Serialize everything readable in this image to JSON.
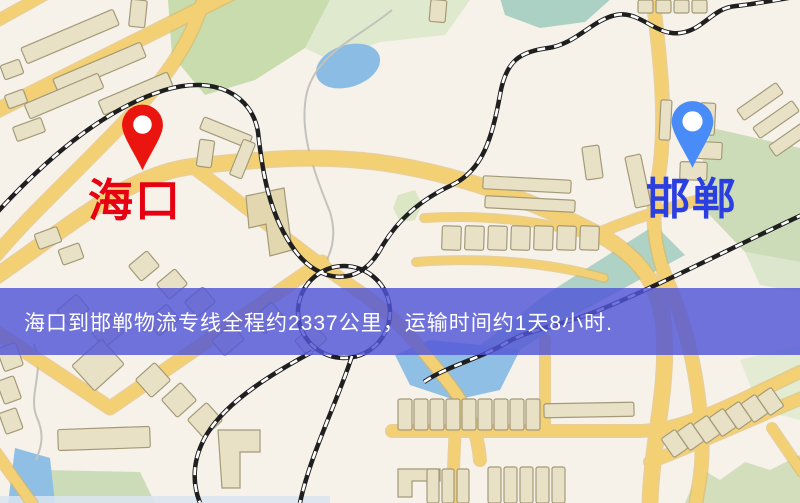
{
  "map": {
    "origin": {
      "name": "海口",
      "marker": "red-pin",
      "marker_color": "#e9150e",
      "label_color": "#e60012"
    },
    "destination": {
      "name": "邯郸",
      "marker": "blue-pin",
      "marker_color": "#4a8cf7",
      "label_color": "#2b3fe0"
    },
    "banner": {
      "text": "海口到邯郸物流专线全程约2337公里，运输时间约1天8小时.",
      "distance_km": "2337",
      "duration": "1天8小时",
      "background_color": "#5256d8",
      "text_color": "#ffffff"
    }
  }
}
